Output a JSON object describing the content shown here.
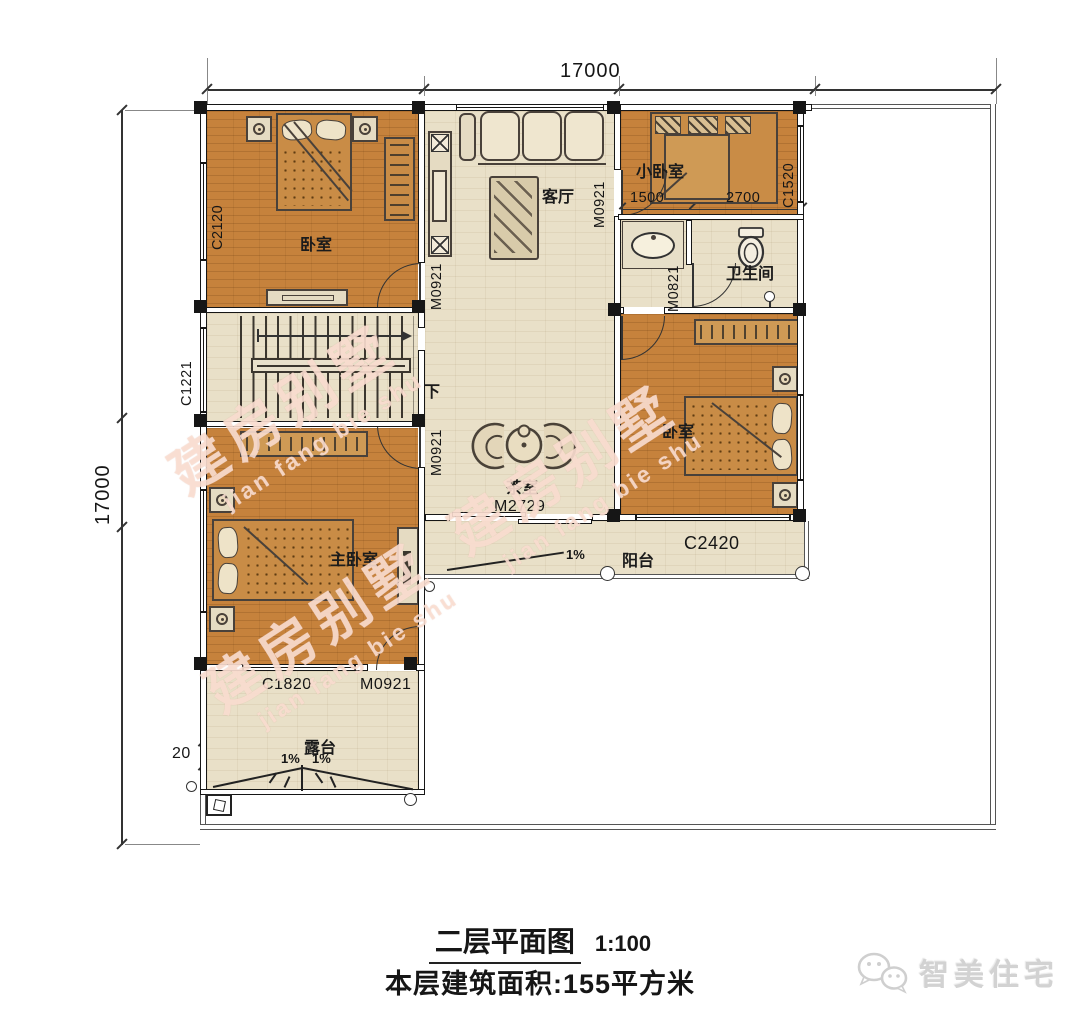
{
  "dims": {
    "width_top": "17000",
    "height_left": "17000",
    "hall": "1500",
    "bed_small_w": "2700",
    "parapet": "20"
  },
  "rooms": {
    "bedroom_nw": "卧室",
    "living": "客厅",
    "bedroom_small": "小卧室",
    "bath": "卫生间",
    "tea": "茶室",
    "bedroom_e": "卧室",
    "master": "主卧室",
    "balcony": "阳台",
    "terrace": "露台",
    "stair_down": "下"
  },
  "openings": {
    "c2120": "C2120",
    "c1221": "C1221",
    "c1520": "C1520",
    "c1820": "C1820",
    "c2420": "C2420",
    "m0921": "M0921",
    "m0821": "M0821",
    "m2729": "M2729"
  },
  "slope": {
    "pct": "1%"
  },
  "title": {
    "main": "二层平面图",
    "scale": "1:100",
    "area": "本层建筑面积:155平方米"
  },
  "watermark": {
    "cn": "建房别墅",
    "en": "jian fang bie shu"
  },
  "brand": {
    "name": "智美住宅"
  }
}
